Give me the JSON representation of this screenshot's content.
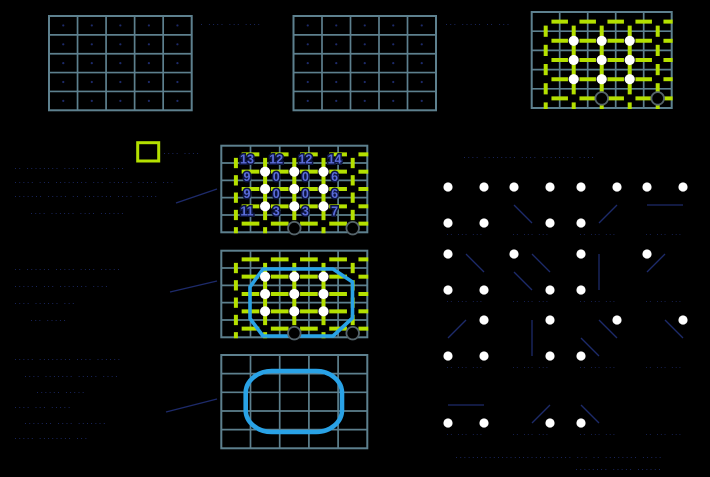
{
  "figure": {
    "width": 710,
    "height": 477,
    "colors": {
      "background": "#000000",
      "grid_line": "#5d808e",
      "green_dash": "#b4e000",
      "white_dot": "#ffffff",
      "open_circle_fill": "#000000",
      "open_circle_stroke": "#55646b",
      "contour_blue": "#29a2e6",
      "number_blue": "#5a6cd8",
      "number_halo": "#0d1440",
      "faint_ink": "#1d2a6a"
    },
    "plain_grids": [
      {
        "name": "sample-grid-1",
        "x": 49,
        "y": 16,
        "cols": 5,
        "rows": 5,
        "cw": 28.54,
        "rh": 18.86,
        "cell_marks": true
      },
      {
        "name": "sample-grid-2",
        "x": 293.5,
        "y": 16,
        "cols": 5,
        "rows": 5,
        "cw": 28.5,
        "rh": 18.86,
        "cell_marks": true
      }
    ],
    "ms_grids": [
      {
        "name": "edge-classified-grid",
        "x": 531.7,
        "y": 12,
        "cols": 5,
        "rows": 5,
        "cw": 28,
        "rh": 19.2,
        "h_gap": 11.5,
        "v_gap": 8,
        "circle_dy": 0,
        "open_circles": [
          [
            2,
            4
          ],
          [
            4,
            4
          ]
        ],
        "numbers": null,
        "octagon": null
      },
      {
        "name": "case-number-grid",
        "x": 221.3,
        "y": 145.7,
        "cols": 5,
        "rows": 5,
        "cw": 29.2,
        "rh": 17.32,
        "h_gap": 11.5,
        "v_gap": 7,
        "circle_dy": 4.5,
        "open_circles": [
          [
            2,
            4
          ],
          [
            4,
            4
          ]
        ],
        "numbers": [
          [
            13,
            12,
            12,
            14
          ],
          [
            9,
            0,
            0,
            6
          ],
          [
            9,
            0,
            0,
            6
          ],
          [
            11,
            3,
            3,
            7
          ]
        ],
        "octagon": null
      },
      {
        "name": "contour-overlay-grid",
        "x": 221.3,
        "y": 250.7,
        "cols": 5,
        "rows": 5,
        "cw": 29.2,
        "rh": 17.32,
        "h_gap": 11.5,
        "v_gap": 7,
        "circle_dy": 4.5,
        "open_circles": [
          [
            2,
            4
          ],
          [
            4,
            4
          ]
        ],
        "numbers": null,
        "octagon": [
          [
            263,
            269
          ],
          [
            333,
            269
          ],
          [
            352.5,
            282
          ],
          [
            352.5,
            318
          ],
          [
            333,
            336
          ],
          [
            263,
            336
          ],
          [
            250,
            318.5
          ],
          [
            250,
            287
          ]
        ]
      }
    ],
    "smooth_grid": {
      "name": "smooth-contour-grid",
      "x": 221.3,
      "y": 355,
      "cols": 5,
      "rows": 5,
      "cw": 29.2,
      "rh": 18.66,
      "blob": {
        "x": 245.7,
        "y": 371,
        "w": 96.3,
        "h": 61,
        "r": 26
      }
    },
    "legend_square": {
      "x": 137.7,
      "y": 142.7,
      "w": 21,
      "h": 18.3,
      "stroke_w": 3
    },
    "case_chart": {
      "x_cols": [
        448,
        514,
        581,
        647
      ],
      "y_rows": [
        187,
        254,
        320,
        387
      ],
      "span": 36,
      "dot_r": 4.6,
      "label_dy": 14,
      "label_glyphs": "·· ··· ···",
      "cases": [
        {
          "index": 15,
          "row": 0,
          "col": 0,
          "corners": [
            "TL",
            "TR",
            "BL",
            "BR"
          ],
          "segs": []
        },
        {
          "index": 14,
          "row": 0,
          "col": 1,
          "corners": [
            "TL",
            "TR",
            "BR"
          ],
          "segs": [
            [
              0,
              0.5,
              0.5,
              1
            ]
          ]
        },
        {
          "index": 13,
          "row": 0,
          "col": 2,
          "corners": [
            "TL",
            "TR",
            "BL"
          ],
          "segs": [
            [
              0.5,
              1,
              1,
              0.5
            ]
          ]
        },
        {
          "index": 12,
          "row": 0,
          "col": 3,
          "corners": [
            "TL",
            "TR"
          ],
          "segs": [
            [
              0,
              0.5,
              1,
              0.5
            ]
          ]
        },
        {
          "index": 11,
          "row": 1,
          "col": 0,
          "corners": [
            "TL",
            "BL",
            "BR"
          ],
          "segs": [
            [
              0.5,
              0,
              1,
              0.5
            ]
          ]
        },
        {
          "index": 10,
          "row": 1,
          "col": 1,
          "corners": [
            "TL",
            "BR"
          ],
          "segs": [
            [
              0.5,
              0,
              1,
              0.5
            ],
            [
              0,
              0.5,
              0.5,
              1
            ]
          ]
        },
        {
          "index": 9,
          "row": 1,
          "col": 2,
          "corners": [
            "TL",
            "BL"
          ],
          "segs": [
            [
              0.5,
              0,
              0.5,
              1
            ]
          ]
        },
        {
          "index": 8,
          "row": 1,
          "col": 3,
          "corners": [
            "TL"
          ],
          "segs": [
            [
              0.5,
              0,
              0,
              0.5
            ]
          ]
        },
        {
          "index": 7,
          "row": 2,
          "col": 0,
          "corners": [
            "TR",
            "BL",
            "BR"
          ],
          "segs": [
            [
              0.5,
              0,
              0,
              0.5
            ]
          ]
        },
        {
          "index": 6,
          "row": 2,
          "col": 1,
          "corners": [
            "TR",
            "BR"
          ],
          "segs": [
            [
              0.5,
              0,
              0.5,
              1
            ]
          ]
        },
        {
          "index": 5,
          "row": 2,
          "col": 2,
          "corners": [
            "TR",
            "BL"
          ],
          "segs": [
            [
              0.5,
              0,
              1,
              0.5
            ],
            [
              0,
              0.5,
              0.5,
              1
            ]
          ]
        },
        {
          "index": 4,
          "row": 2,
          "col": 3,
          "corners": [
            "TR"
          ],
          "segs": [
            [
              0.5,
              0,
              1,
              0.5
            ]
          ]
        },
        {
          "index": 3,
          "row": 3,
          "col": 0,
          "corners": [
            "BL",
            "BR"
          ],
          "segs": [
            [
              0,
              0.5,
              1,
              0.5
            ]
          ]
        },
        {
          "index": 2,
          "row": 3,
          "col": 1,
          "corners": [
            "BR"
          ],
          "segs": [
            [
              1,
              0.5,
              0.5,
              1
            ]
          ]
        },
        {
          "index": 1,
          "row": 3,
          "col": 2,
          "corners": [
            "BL"
          ],
          "segs": [
            [
              0,
              0.5,
              0.5,
              1
            ]
          ]
        },
        {
          "index": 0,
          "row": 3,
          "col": 3,
          "corners": [],
          "segs": []
        }
      ]
    },
    "arrows": [
      {
        "x1": 176,
        "y1": 203,
        "x2": 217,
        "y2": 189
      },
      {
        "x1": 170,
        "y1": 292,
        "x2": 217,
        "y2": 281
      },
      {
        "x1": 166,
        "y1": 412,
        "x2": 217,
        "y2": 399
      }
    ],
    "illegible_text": [
      {
        "x": 200,
        "y": 27,
        "t": "· ···· ··· ····"
      },
      {
        "x": 445,
        "y": 27,
        "t": "··· ····· ·· ···"
      },
      {
        "x": 163,
        "y": 156,
        "t": "···· ····"
      },
      {
        "x": 463,
        "y": 160,
        "t": "···· ········ ···· ········ ····"
      },
      {
        "x": 14,
        "y": 171,
        "t": "·· ········ ···· ······ ···"
      },
      {
        "x": 14,
        "y": 185,
        "t": "····· ··· ········ ··· ······ ····· ···"
      },
      {
        "x": 14,
        "y": 199,
        "t": "······· ····· ·· ······· ···· ·····"
      },
      {
        "x": 30,
        "y": 216,
        "t": "···· ······ ···· ······"
      },
      {
        "x": 14,
        "y": 272,
        "t": "·· ······ ····· ···· ·····"
      },
      {
        "x": 14,
        "y": 289,
        "t": "······ ··· ······· ····"
      },
      {
        "x": 14,
        "y": 306,
        "t": "···· ······ ···"
      },
      {
        "x": 30,
        "y": 323,
        "t": "··· ·····"
      },
      {
        "x": 14,
        "y": 362,
        "t": "····· ········ ···· ······"
      },
      {
        "x": 24,
        "y": 379,
        "t": "···· ······· ····· ····"
      },
      {
        "x": 36,
        "y": 395,
        "t": "······ ·····"
      },
      {
        "x": 14,
        "y": 410,
        "t": "···· ··· ·····"
      },
      {
        "x": 24,
        "y": 426,
        "t": "······· ···· ·······"
      },
      {
        "x": 14,
        "y": 441,
        "t": "····· ········ ···"
      },
      {
        "x": 455,
        "y": 460,
        "t": "···························· ··· ·· ········ ·····"
      },
      {
        "x": 575,
        "y": 472,
        "t": "········ ····· ······"
      }
    ]
  }
}
